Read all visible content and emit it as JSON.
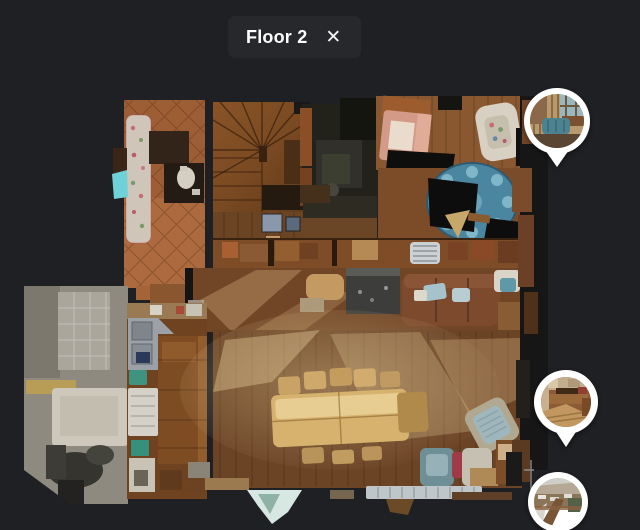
{
  "header": {
    "floor_label": "Floor 2",
    "close_icon": "✕"
  },
  "floorplan": {
    "floor_name": "Floor 2"
  },
  "pins": [
    {
      "id": "pano-pin-top",
      "thumbnail_alt": "wood-panelled lounge with blue sofa"
    },
    {
      "id": "pano-pin-middle",
      "thumbnail_alt": "kitchen and dining area"
    },
    {
      "id": "pano-pin-bottom",
      "thumbnail_alt": "snowy village view from balcony"
    }
  ],
  "colors": {
    "background": "#1e2023",
    "header_pill": "#27282b",
    "title_text": "#ffffff",
    "pin_border": "#ffffff"
  }
}
